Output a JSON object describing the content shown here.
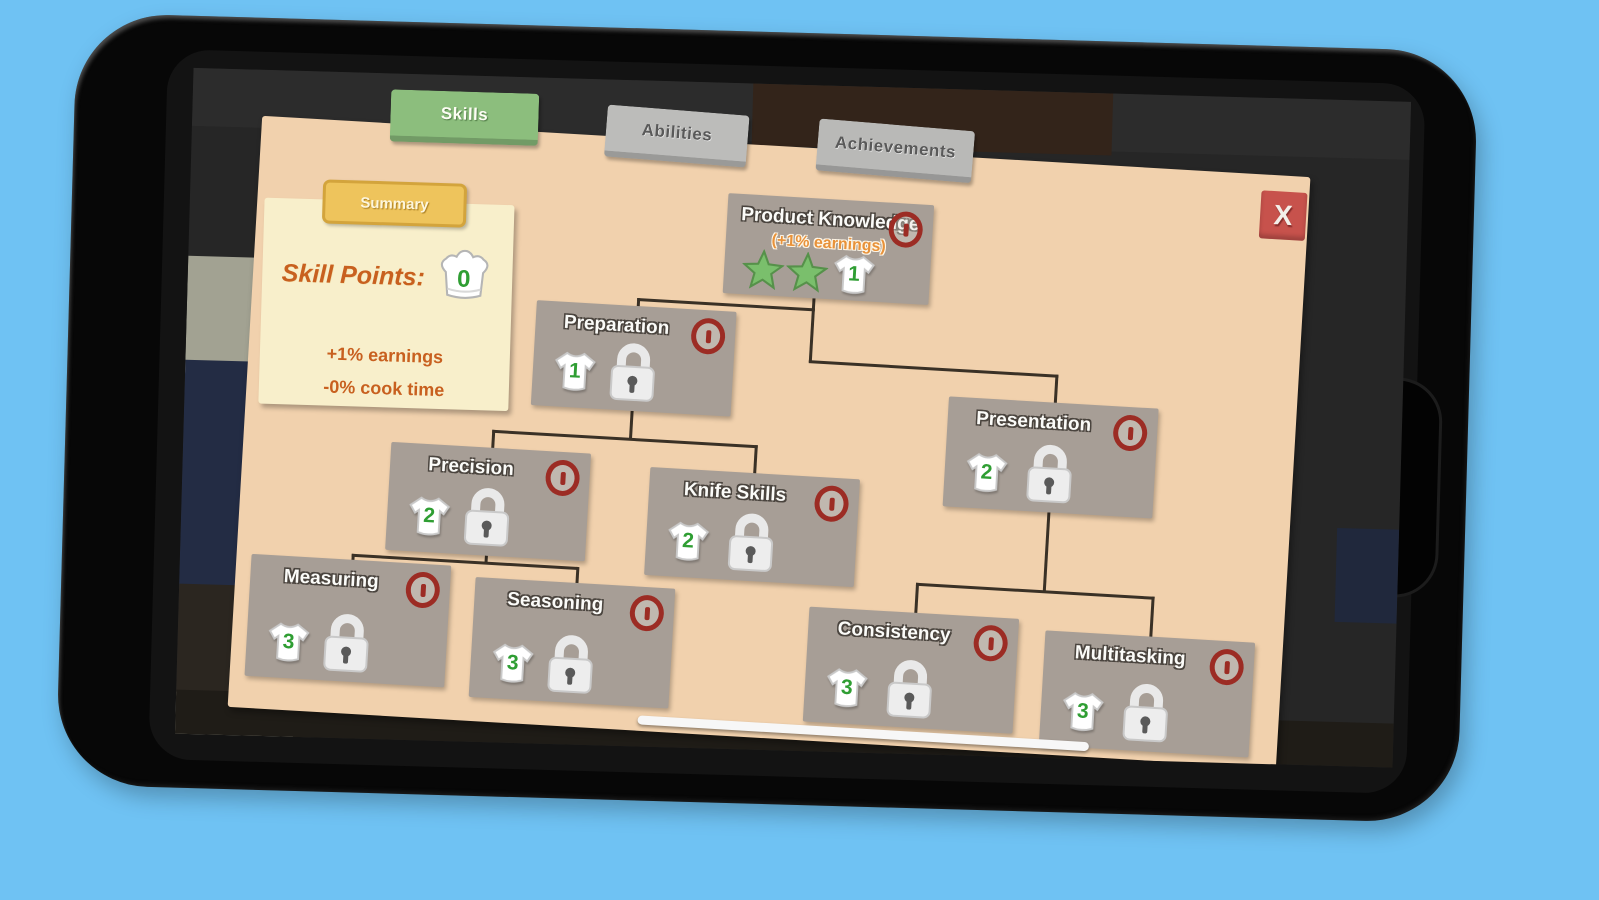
{
  "tabs": [
    {
      "label": "Skills",
      "active": true
    },
    {
      "label": "Abilities",
      "active": false
    },
    {
      "label": "Achievements",
      "active": false
    }
  ],
  "close": {
    "label": "X"
  },
  "summary": {
    "tab_label": "Summary",
    "skill_points_label": "Skill Points:",
    "skill_points_value": "0",
    "effects": [
      "+1% earnings",
      "-0% cook time"
    ]
  },
  "skill_tree": {
    "nodes": [
      {
        "id": "product-knowledge",
        "name": "Product Knowledge",
        "bonus": "(+1% earnings)",
        "stars": 2,
        "cost": "1",
        "locked": false
      },
      {
        "id": "preparation",
        "name": "Preparation",
        "cost": "1",
        "locked": true
      },
      {
        "id": "presentation",
        "name": "Presentation",
        "cost": "2",
        "locked": true
      },
      {
        "id": "precision",
        "name": "Precision",
        "cost": "2",
        "locked": true
      },
      {
        "id": "knife-skills",
        "name": "Knife Skills",
        "cost": "2",
        "locked": true
      },
      {
        "id": "measuring",
        "name": "Measuring",
        "cost": "3",
        "locked": true
      },
      {
        "id": "seasoning",
        "name": "Seasoning",
        "cost": "3",
        "locked": true
      },
      {
        "id": "consistency",
        "name": "Consistency",
        "cost": "3",
        "locked": true
      },
      {
        "id": "multitasking",
        "name": "Multitasking",
        "cost": "3",
        "locked": true
      }
    ]
  },
  "colors": {
    "page_background": "#6fc2f3",
    "panel_tan": "#f1d1ad",
    "note_cream": "#f8efcb",
    "node_gray": "#a79e96",
    "active_tab_green": "#8cbe7d",
    "summary_gold": "#eec45c",
    "info_red": "#9c2c24",
    "close_red": "#c7524c",
    "accent_orange": "#c8601f",
    "star_green": "#7abf6c",
    "cost_green": "#2f9e33"
  }
}
